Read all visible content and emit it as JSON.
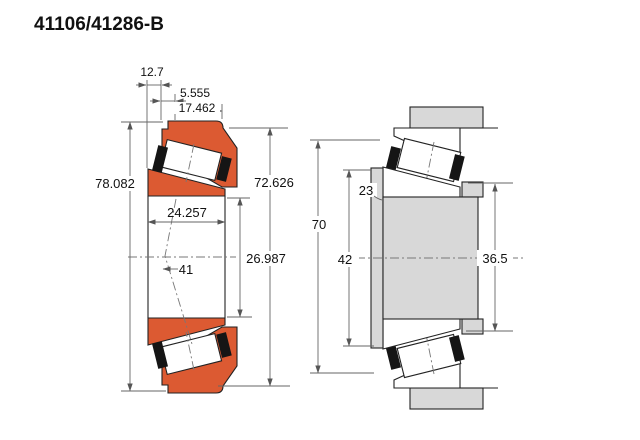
{
  "title": "41106/41286-B",
  "colors": {
    "ring_orange": "#dc5a32",
    "steel_gray": "#d8d8d8",
    "outline": "#222222",
    "dim_line": "#666666"
  },
  "left_view": {
    "label": "bearing cross-section",
    "dims": {
      "step_width": "12.7",
      "flange_width": "5.555",
      "cup_width": "17.462",
      "outer_diameter": "78.082",
      "cup_inner_diameter": "72.626",
      "bore_width": "24.257",
      "bore_diameter": "26.987",
      "apex_distance": "41"
    }
  },
  "right_view": {
    "label": "mounted bearing section",
    "dims": {
      "housing_bore": "70",
      "shaft_shoulder": "42",
      "fillet": "23",
      "abutment_diameter": "36.5"
    }
  }
}
